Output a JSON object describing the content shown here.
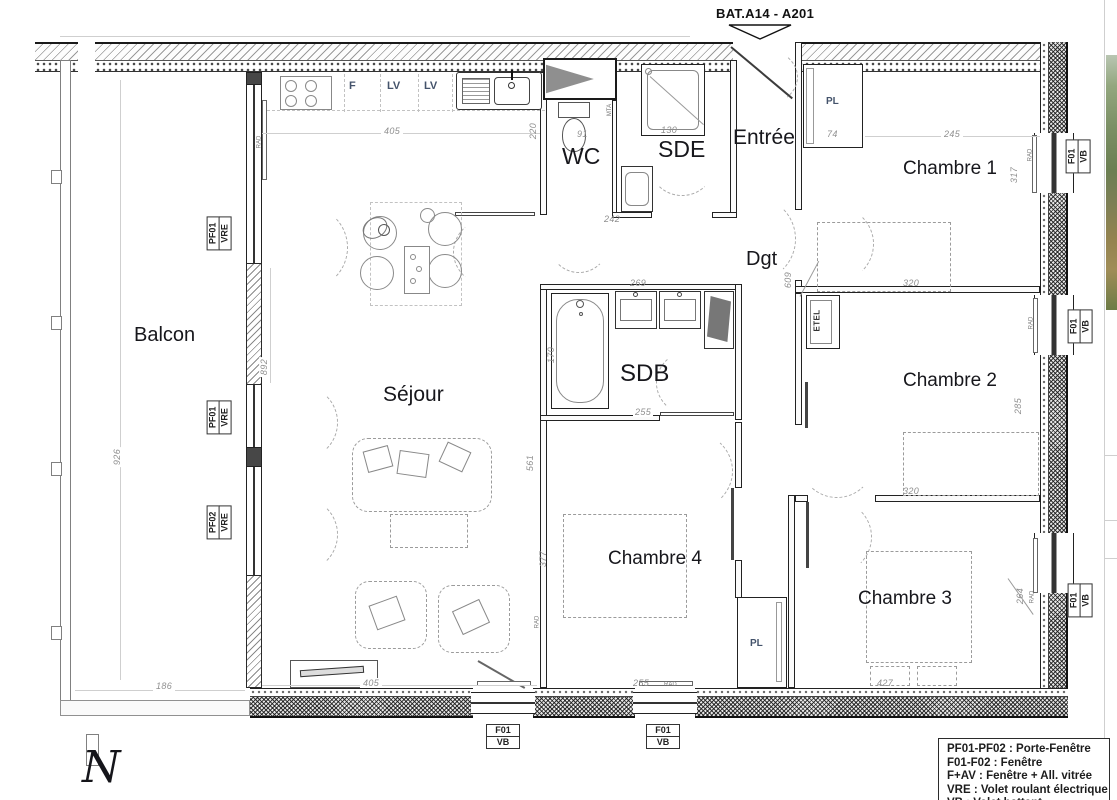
{
  "annotations": {
    "bat_ref": "BAT.A14 - A201",
    "north": "N"
  },
  "rooms": {
    "balcon": "Balcon",
    "sejour": "Séjour",
    "wc": "WC",
    "sde": "SDE",
    "entree": "Entrée",
    "dgt": "Dgt",
    "sdb": "SDB",
    "chambre1": "Chambre 1",
    "chambre2": "Chambre 2",
    "chambre3": "Chambre 3",
    "chambre4": "Chambre 4"
  },
  "fixtures": {
    "pl_entree": "PL",
    "pl_couloir": "PL",
    "etel": "ETEL",
    "mta": "MTA",
    "rad": "RAD",
    "kitchen_f": "F",
    "kitchen_lv1": "LV",
    "kitchen_lv2": "LV"
  },
  "window_tags": {
    "pf01": [
      "PF01",
      "VRE"
    ],
    "pf02": [
      "PF02",
      "VRE"
    ],
    "f01": [
      "F01",
      "VB"
    ]
  },
  "dimensions": {
    "kitchen_width": "405",
    "kitchen_depth": "220",
    "wc_width": "91",
    "sde_width": "130",
    "sde_total": "242",
    "sdb_width": "269",
    "entree_pl": "74",
    "ch1_width": "245",
    "ch1_depth": "317",
    "ch1_bottom": "320",
    "dgt_length": "609",
    "ch2_depth": "285",
    "ch2_bottom": "320",
    "bath_length": "170",
    "sdb_bottom": "255",
    "sejour_height": "561",
    "ch4_depth": "377",
    "ch4_bottom": "255",
    "sejour_bottom": "405",
    "ch3_bottom": "427",
    "ch3_depth": "264",
    "balcon_width": "186",
    "balcon_length": "926",
    "sejour_side": "892"
  },
  "legend": {
    "lines": [
      "PF01-PF02 : Porte-Fenêtre",
      "F01-F02 : Fenêtre",
      "F+AV : Fenêtre + All. vitrée",
      "VRE : Volet roulant électrique",
      "VB : Volet battant"
    ]
  }
}
